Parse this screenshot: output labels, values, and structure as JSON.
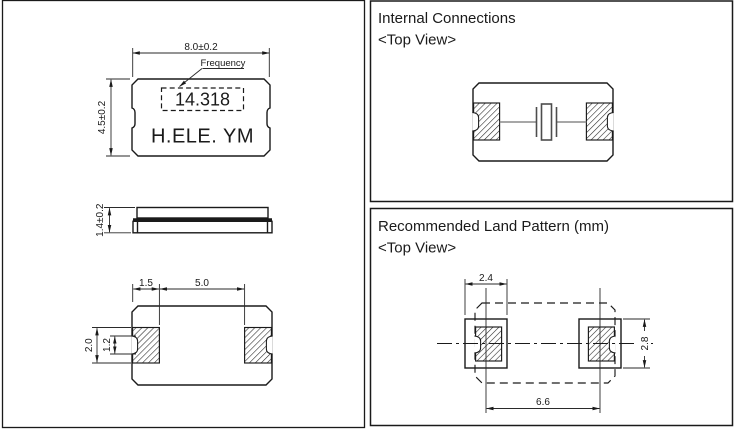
{
  "colors": {
    "ink": "#1a1a1a",
    "wire": "#8a8a8a"
  },
  "package_drawing": {
    "top_view": {
      "body_width_dim": "8.0±0.2",
      "body_height_dim": "4.5±0.2",
      "frequency_label": "Frequency",
      "frequency_marking": "14.318",
      "logo_marking": "H.ELE. YM"
    },
    "side_view": {
      "thickness_dim": "1.4±0.2"
    },
    "bottom_view": {
      "pad_width_dim": "1.5",
      "pad_gap_dim": "5.0",
      "pad_height_dim": "2.0",
      "castellation_dim": "1.2"
    }
  },
  "internal_connections_panel": {
    "title": "Internal Connections",
    "view_label": "<Top View>"
  },
  "land_pattern_panel": {
    "title": "Recommended Land Pattern (mm)",
    "view_label": "<Top View>",
    "pad_width_dim": "2.4",
    "pad_height_dim": "2.8",
    "pad_span_dim": "6.6"
  }
}
